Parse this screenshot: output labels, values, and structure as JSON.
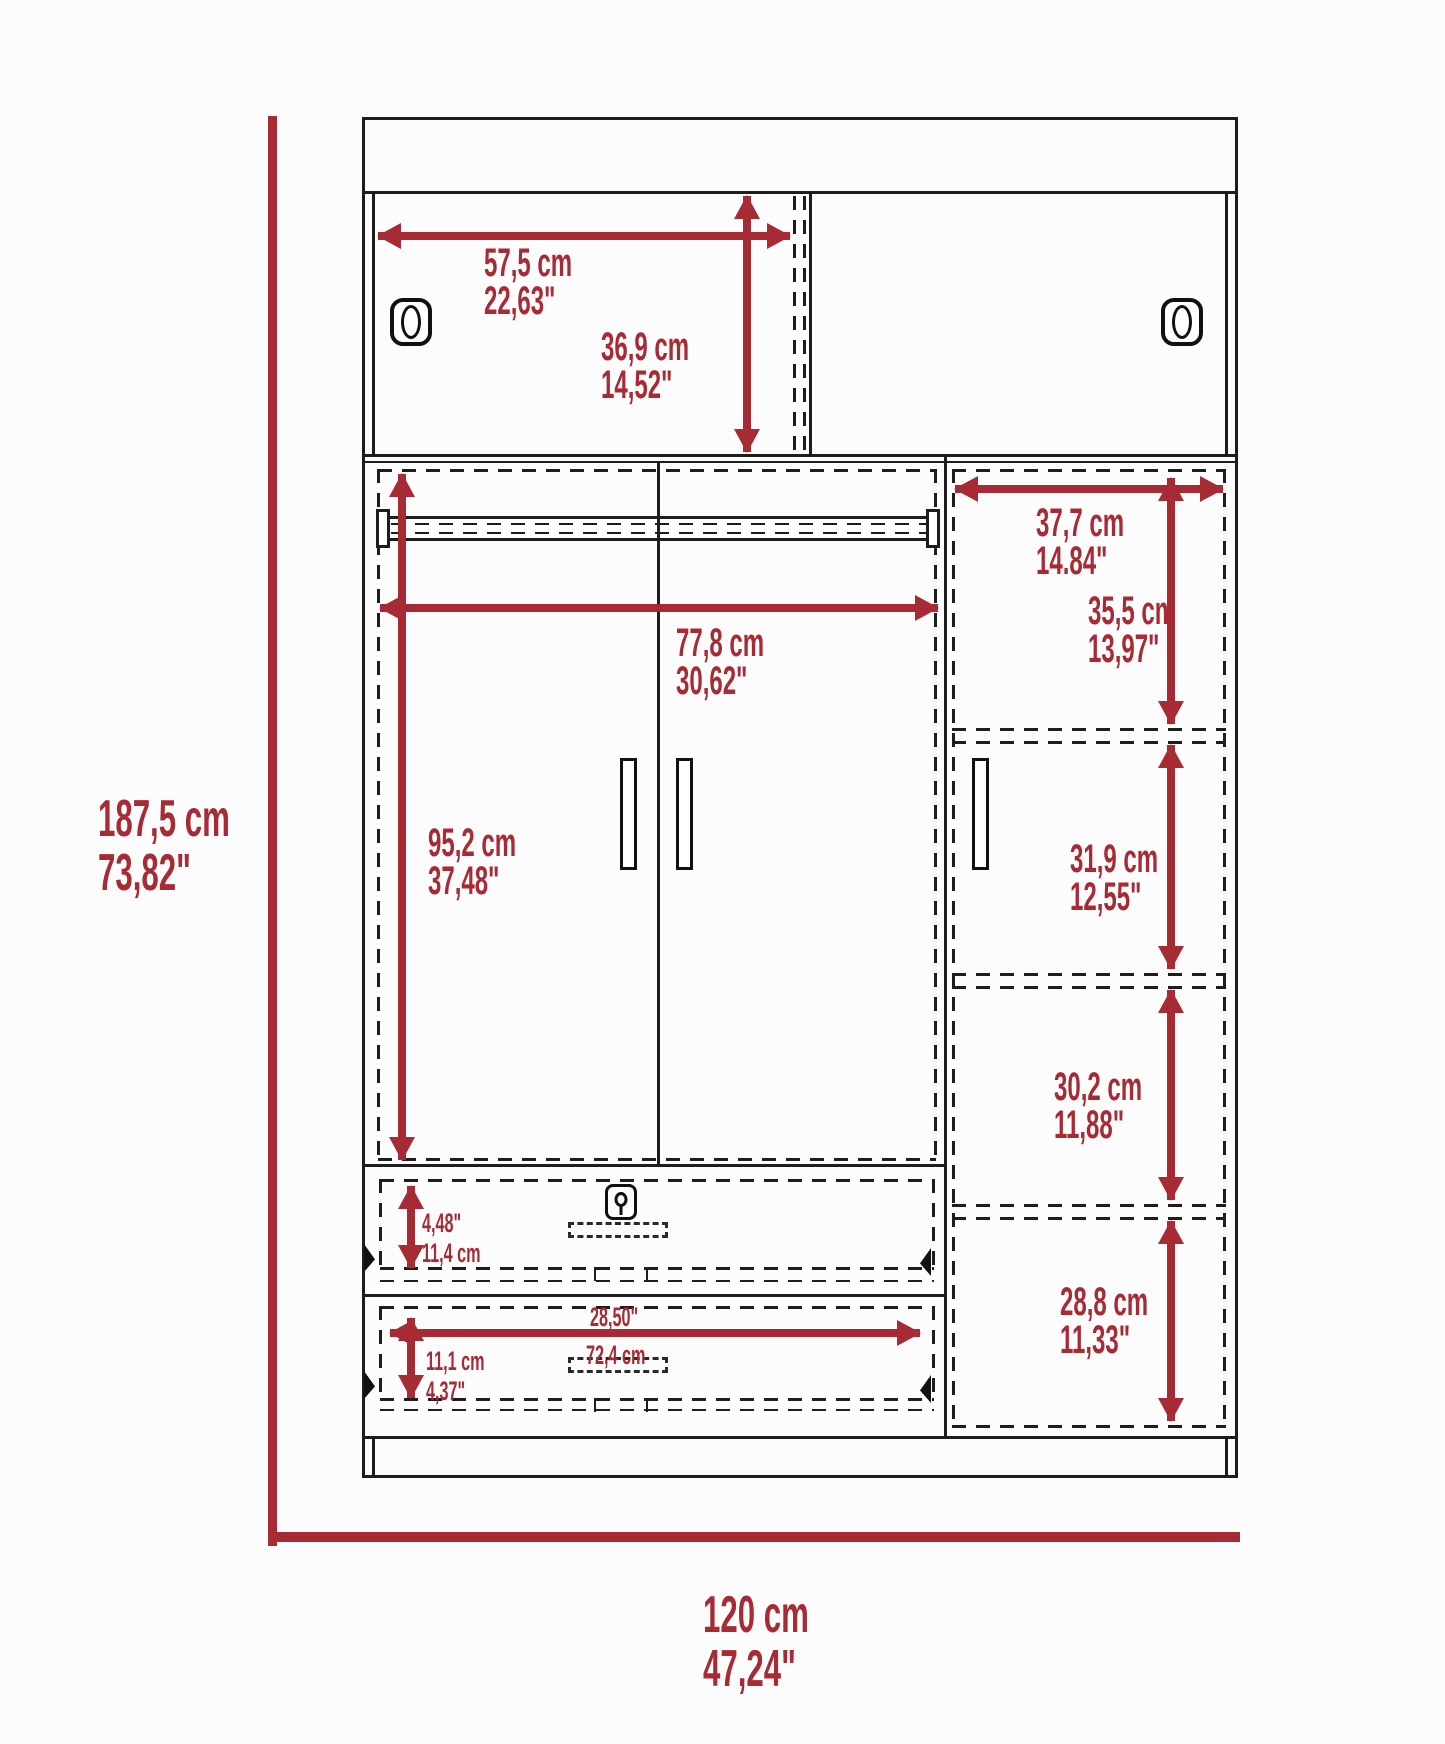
{
  "colors": {
    "accent": "#A72B35",
    "line": "#1D1D1D",
    "background": "#FCFCFC"
  },
  "overall": {
    "height_cm": "187,5 cm",
    "height_in": "73,82\"",
    "width_cm": "120 cm",
    "width_in": "47,24\""
  },
  "top_section": {
    "door_width_cm": "57,5 cm",
    "door_width_in": "22,63\"",
    "door_height_cm": "36,9 cm",
    "door_height_in": "14,52\""
  },
  "wardrobe_section": {
    "width_cm": "77,8 cm",
    "width_in": "30,62\"",
    "height_cm": "95,2 cm",
    "height_in": "37,48\""
  },
  "right_column": {
    "width_cm": "37,7 cm",
    "width_in": "14.84\"",
    "shelf1_cm": "35,5 cm",
    "shelf1_in": "13,97\"",
    "shelf2_cm": "31,9 cm",
    "shelf2_in": "12,55\"",
    "shelf3_cm": "30,2 cm",
    "shelf3_in": "11,88\"",
    "shelf4_cm": "28,8 cm",
    "shelf4_in": "11,33\""
  },
  "drawers": {
    "top_height_in": "4,48\"",
    "top_height_cm": "11,4 cm",
    "bottom_width_in": "28,50\"",
    "bottom_width_cm": "72,4 cm",
    "bottom_height_cm": "11,1 cm",
    "bottom_height_in": "4,37\""
  }
}
